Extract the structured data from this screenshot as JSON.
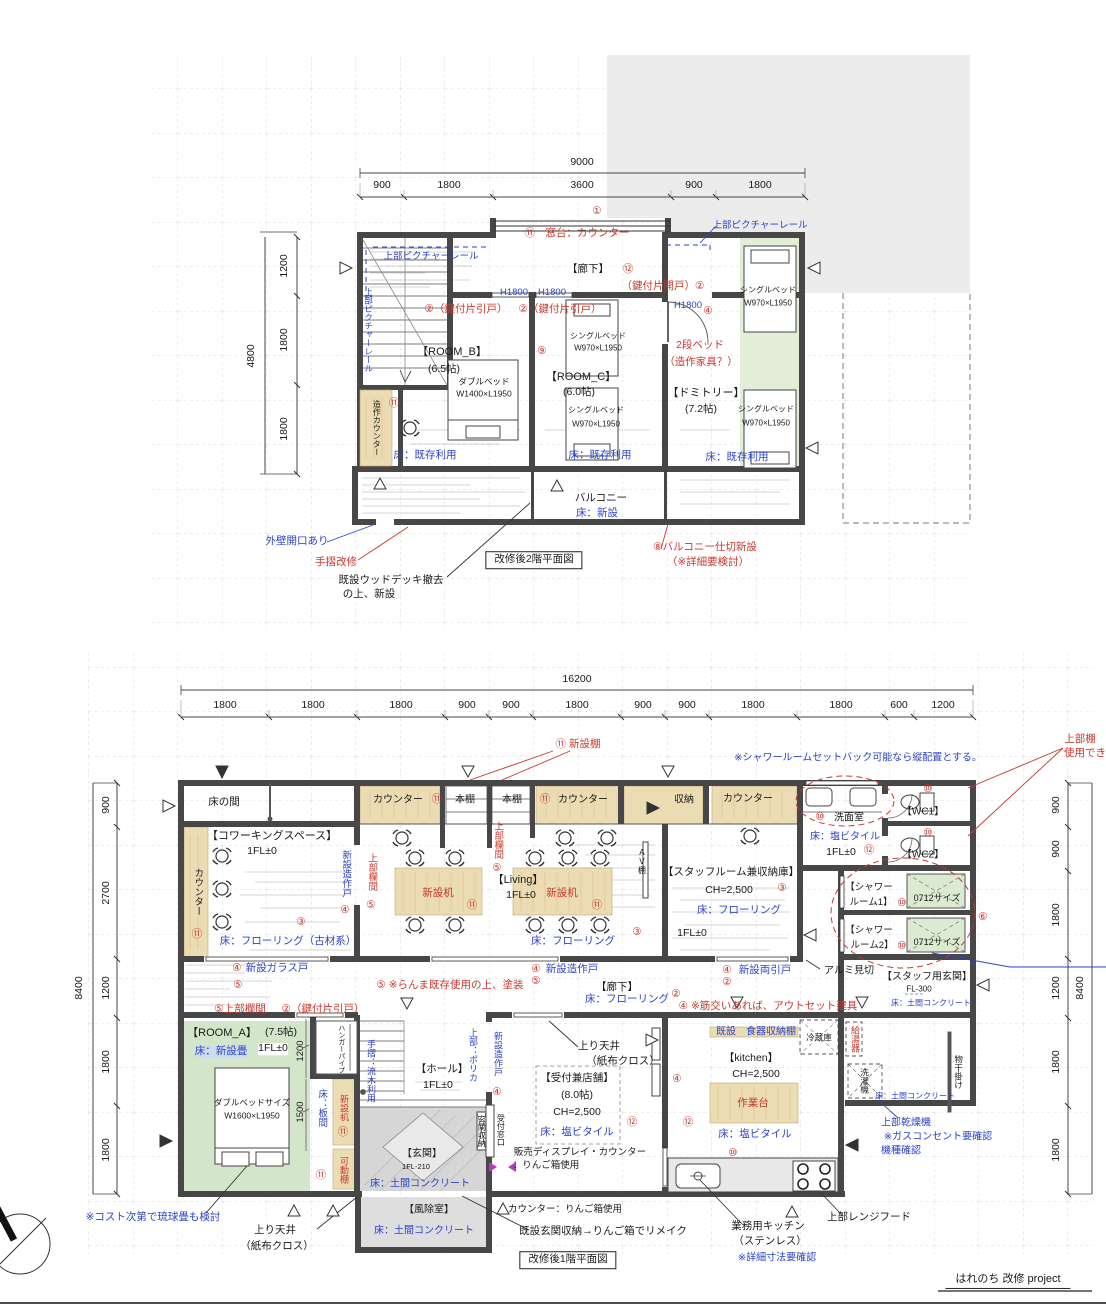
{
  "colors": {
    "red": "#c8372d",
    "blue": "#2b43c8",
    "black": "#1a1a1a",
    "magenta": "#b935c9"
  },
  "project": {
    "title": "はれのち 改修 project"
  },
  "plan2f_title": "改修後2階平面図",
  "plan1f_title": "改修後1階平面図",
  "labels2f": [
    {
      "n": "dim-total-2f",
      "t": "9000",
      "x": 582,
      "y": 163
    },
    {
      "t": "900",
      "x": 382,
      "y": 186
    },
    {
      "t": "1800",
      "x": 449,
      "y": 186
    },
    {
      "t": "3600",
      "x": 582,
      "y": 186
    },
    {
      "t": "900",
      "x": 694,
      "y": 186
    },
    {
      "t": "1800",
      "x": 760,
      "y": 186
    },
    {
      "t": "4800",
      "x": 252,
      "y": 356,
      "r": -90
    },
    {
      "t": "1200",
      "x": 285,
      "y": 266,
      "r": -90
    },
    {
      "t": "1800",
      "x": 285,
      "y": 340,
      "r": -90
    },
    {
      "t": "1800",
      "x": 285,
      "y": 429,
      "r": -90
    },
    {
      "t": "①",
      "x": 597,
      "y": 212,
      "c": "red"
    },
    {
      "t": "⑪　窓台：カウンター",
      "x": 577,
      "y": 234,
      "c": "red"
    },
    {
      "t": "上部ピクチャーレール",
      "x": 760,
      "y": 226,
      "c": "blue",
      "s": 9.5
    },
    {
      "t": "上部ピクチャーレール",
      "x": 431,
      "y": 257,
      "c": "blue",
      "s": 9.5
    },
    {
      "t": "上部ピクチャーレール",
      "x": 368,
      "y": 330,
      "c": "blue",
      "s": 8.5,
      "v": 1
    },
    {
      "t": "【廊下】",
      "x": 588,
      "y": 270
    },
    {
      "t": "⑫",
      "x": 628,
      "y": 270,
      "c": "red"
    },
    {
      "t": "（鍵付片開戸）②",
      "x": 663,
      "y": 287,
      "c": "red"
    },
    {
      "t": "H1800",
      "x": 514,
      "y": 293,
      "c": "blue",
      "s": 9.5
    },
    {
      "t": "H1800",
      "x": 552,
      "y": 293,
      "c": "blue",
      "s": 9.5
    },
    {
      "t": "②（鍵付片引戸）",
      "x": 466,
      "y": 310,
      "c": "red"
    },
    {
      "t": "②（鍵付片引戸）",
      "x": 560,
      "y": 310,
      "c": "red"
    },
    {
      "t": "H1800",
      "x": 688,
      "y": 306,
      "c": "blue",
      "s": 9.5
    },
    {
      "t": "④",
      "x": 708,
      "y": 312,
      "c": "red"
    },
    {
      "t": "⑨",
      "x": 542,
      "y": 352,
      "c": "red"
    },
    {
      "n": "room-b-title",
      "t": "【ROOM_B】",
      "x": 452,
      "y": 352,
      "s": 11
    },
    {
      "t": "(6.5帖)",
      "x": 444,
      "y": 370
    },
    {
      "t": "ダブルベッド",
      "x": 484,
      "y": 382,
      "s": 8.5
    },
    {
      "t": "W1400×L1950",
      "x": 484,
      "y": 394,
      "s": 8.5
    },
    {
      "n": "room-c-title",
      "t": "【ROOM_C】",
      "x": 581,
      "y": 377,
      "s": 11
    },
    {
      "t": "(6.0帖)",
      "x": 579,
      "y": 393
    },
    {
      "t": "シングルベッド",
      "x": 598,
      "y": 337,
      "s": 8
    },
    {
      "t": "W970×L1950",
      "x": 598,
      "y": 349,
      "s": 8
    },
    {
      "t": "シングルベッド",
      "x": 596,
      "y": 411,
      "s": 8
    },
    {
      "t": "W970×L1950",
      "x": 596,
      "y": 425,
      "s": 8
    },
    {
      "t": "2段ベッド",
      "x": 700,
      "y": 346,
      "c": "red"
    },
    {
      "t": "（造作家具？）",
      "x": 701,
      "y": 363,
      "c": "red"
    },
    {
      "n": "dormitory-title",
      "t": "【ドミトリー】",
      "x": 706,
      "y": 393,
      "s": 11
    },
    {
      "t": "(7.2帖)",
      "x": 701,
      "y": 410
    },
    {
      "t": "シングルベッド",
      "x": 768,
      "y": 291,
      "s": 8
    },
    {
      "t": "W970×L1950",
      "x": 768,
      "y": 304,
      "s": 8
    },
    {
      "t": "シングルベッド",
      "x": 766,
      "y": 410,
      "s": 8
    },
    {
      "t": "W970×L1950",
      "x": 766,
      "y": 424,
      "s": 8
    },
    {
      "t": "床：既存利用",
      "x": 425,
      "y": 456,
      "c": "blue"
    },
    {
      "t": "床：既存利用",
      "x": 600,
      "y": 456,
      "c": "blue"
    },
    {
      "t": "床：既存利用",
      "x": 737,
      "y": 458,
      "c": "blue"
    },
    {
      "t": "造作カウンター",
      "x": 376,
      "y": 428,
      "s": 8,
      "v": 1
    },
    {
      "t": "⑪",
      "x": 394,
      "y": 404,
      "c": "red"
    },
    {
      "t": "バルコニー",
      "x": 601,
      "y": 499
    },
    {
      "t": "床：新設",
      "x": 597,
      "y": 514,
      "c": "blue"
    },
    {
      "t": "外壁開口あり",
      "x": 297,
      "y": 542,
      "c": "blue"
    },
    {
      "t": "手摺改修",
      "x": 336,
      "y": 563,
      "c": "red"
    },
    {
      "t": "既設ウッドデッキ撤去",
      "x": 391,
      "y": 581
    },
    {
      "t": "の上、新設",
      "x": 369,
      "y": 595
    },
    {
      "n": "plan2f-title",
      "t": "改修後2階平面図",
      "x": 534,
      "y": 560,
      "bd": 1
    },
    {
      "t": "⑧バルコニー仕切新設",
      "x": 705,
      "y": 548,
      "c": "red"
    },
    {
      "t": "（※詳細要検討）",
      "x": 708,
      "y": 563,
      "c": "red"
    }
  ],
  "labels1f": [
    {
      "n": "dim-total-1f",
      "t": "16200",
      "x": 577,
      "y": 680
    },
    {
      "t": "1800",
      "x": 225,
      "y": 706
    },
    {
      "t": "1800",
      "x": 313,
      "y": 706
    },
    {
      "t": "1800",
      "x": 401,
      "y": 706
    },
    {
      "t": "900",
      "x": 467,
      "y": 706
    },
    {
      "t": "900",
      "x": 511,
      "y": 706
    },
    {
      "t": "1800",
      "x": 577,
      "y": 706
    },
    {
      "t": "900",
      "x": 643,
      "y": 706
    },
    {
      "t": "900",
      "x": 687,
      "y": 706
    },
    {
      "t": "1800",
      "x": 753,
      "y": 706
    },
    {
      "t": "1800",
      "x": 841,
      "y": 706
    },
    {
      "t": "600",
      "x": 899,
      "y": 706
    },
    {
      "t": "1200",
      "x": 943,
      "y": 706
    },
    {
      "t": "8400",
      "x": 80,
      "y": 988,
      "r": -90
    },
    {
      "t": "900",
      "x": 107,
      "y": 805,
      "r": -90
    },
    {
      "t": "2700",
      "x": 107,
      "y": 893,
      "r": -90
    },
    {
      "t": "1200",
      "x": 107,
      "y": 988,
      "r": -90
    },
    {
      "t": "1800",
      "x": 107,
      "y": 1062,
      "r": -90
    },
    {
      "t": "1800",
      "x": 107,
      "y": 1150,
      "r": -90
    },
    {
      "t": "900",
      "x": 1057,
      "y": 805,
      "r": -90
    },
    {
      "t": "900",
      "x": 1057,
      "y": 849,
      "r": -90
    },
    {
      "t": "1800",
      "x": 1057,
      "y": 915,
      "r": -90
    },
    {
      "t": "1200",
      "x": 1057,
      "y": 988,
      "r": -90
    },
    {
      "t": "1800",
      "x": 1057,
      "y": 1062,
      "r": -90
    },
    {
      "t": "1800",
      "x": 1057,
      "y": 1150,
      "r": -90
    },
    {
      "t": "8400",
      "x": 1081,
      "y": 988,
      "r": -90
    },
    {
      "t": "⑪ 新設棚",
      "x": 578,
      "y": 745,
      "c": "red"
    },
    {
      "t": "※シャワールームセットバック可能なら縦配置とする。",
      "x": 858,
      "y": 758,
      "c": "blue",
      "s": 10
    },
    {
      "t": "上部棚",
      "x": 1080,
      "y": 740,
      "c": "red"
    },
    {
      "t": "使用でき",
      "x": 1085,
      "y": 754,
      "c": "red"
    },
    {
      "t": "床の間",
      "x": 224,
      "y": 803
    },
    {
      "t": "カウンター",
      "x": 398,
      "y": 800,
      "s": 10
    },
    {
      "t": "⑪",
      "x": 437,
      "y": 800,
      "c": "red"
    },
    {
      "t": "本棚",
      "x": 465,
      "y": 800,
      "s": 10
    },
    {
      "t": "本棚",
      "x": 512,
      "y": 800,
      "s": 10
    },
    {
      "t": "⑪",
      "x": 545,
      "y": 800,
      "c": "red"
    },
    {
      "t": "カウンター",
      "x": 583,
      "y": 800,
      "s": 10
    },
    {
      "t": "収納",
      "x": 684,
      "y": 800,
      "s": 10
    },
    {
      "t": "カウンター",
      "x": 748,
      "y": 799,
      "s": 10
    },
    {
      "t": "⑩",
      "x": 820,
      "y": 818,
      "c": "red"
    },
    {
      "t": "洗面室",
      "x": 849,
      "y": 818,
      "s": 10
    },
    {
      "t": "床：塩ビタイル",
      "x": 845,
      "y": 837,
      "c": "blue",
      "s": 10
    },
    {
      "t": "1FL±0",
      "x": 841,
      "y": 853
    },
    {
      "t": "⑫",
      "x": 869,
      "y": 851,
      "c": "red"
    },
    {
      "n": "wc1-title",
      "t": "【WC1】",
      "x": 923,
      "y": 812,
      "s": 10
    },
    {
      "t": "⑩",
      "x": 928,
      "y": 790,
      "c": "red"
    },
    {
      "n": "wc2-title",
      "t": "【WC2】",
      "x": 923,
      "y": 855,
      "s": 10
    },
    {
      "t": "⑩",
      "x": 928,
      "y": 834,
      "c": "red"
    },
    {
      "t": "【シャワー",
      "x": 869,
      "y": 888,
      "s": 9.5
    },
    {
      "t": "ルーム1】",
      "x": 871,
      "y": 903,
      "s": 9.5
    },
    {
      "t": "⑩",
      "x": 902,
      "y": 904,
      "c": "red"
    },
    {
      "t": "0712サイズ",
      "x": 937,
      "y": 899,
      "s": 9
    },
    {
      "t": "【シャワー",
      "x": 869,
      "y": 931,
      "s": 9.5
    },
    {
      "t": "ルーム2】",
      "x": 872,
      "y": 946,
      "s": 9.5
    },
    {
      "t": "⑩",
      "x": 902,
      "y": 947,
      "c": "red"
    },
    {
      "t": "0712サイズ",
      "x": 937,
      "y": 943,
      "s": 9
    },
    {
      "t": "⑥",
      "x": 983,
      "y": 918,
      "c": "red"
    },
    {
      "t": "アルミ見切",
      "x": 849,
      "y": 971,
      "s": 10
    },
    {
      "n": "staff-entrance-title",
      "t": "【スタッフ用玄関】",
      "x": 927,
      "y": 977,
      "s": 10
    },
    {
      "t": "FL-300",
      "x": 919,
      "y": 990,
      "s": 8
    },
    {
      "t": "床：土間コンクリート",
      "x": 931,
      "y": 1004,
      "c": "blue",
      "s": 8
    },
    {
      "n": "coworking-title",
      "t": "【コワーキングスペース】",
      "x": 272,
      "y": 836,
      "s": 11
    },
    {
      "t": "1FL±0",
      "x": 262,
      "y": 852
    },
    {
      "t": "カウンター",
      "x": 197,
      "y": 892,
      "s": 9.5,
      "v": 1
    },
    {
      "t": "⑪",
      "x": 197,
      "y": 935,
      "c": "red"
    },
    {
      "t": "③",
      "x": 301,
      "y": 923,
      "c": "red"
    },
    {
      "t": "床：フローリング（古材系）",
      "x": 288,
      "y": 942,
      "c": "blue"
    },
    {
      "t": "新設造作戸",
      "x": 345,
      "y": 874,
      "c": "blue",
      "s": 9.5,
      "v": 1
    },
    {
      "t": "④",
      "x": 345,
      "y": 911,
      "c": "red"
    },
    {
      "t": "上部欄間",
      "x": 371,
      "y": 872,
      "c": "red",
      "s": 9.5,
      "v": 1
    },
    {
      "t": "⑤",
      "x": 371,
      "y": 906,
      "c": "red"
    },
    {
      "t": "新設机",
      "x": 438,
      "y": 894,
      "c": "red"
    },
    {
      "t": "⑪",
      "x": 472,
      "y": 906,
      "c": "red"
    },
    {
      "n": "living-title",
      "t": "【Living】",
      "x": 518,
      "y": 880,
      "s": 11
    },
    {
      "t": "1FL±0",
      "x": 521,
      "y": 896
    },
    {
      "t": "新設机",
      "x": 562,
      "y": 894,
      "c": "red"
    },
    {
      "t": "⑪",
      "x": 597,
      "y": 906,
      "c": "red"
    },
    {
      "t": "上部欄間",
      "x": 497,
      "y": 840,
      "c": "red",
      "s": 9.5,
      "v": 1
    },
    {
      "t": "⑤",
      "x": 497,
      "y": 869,
      "c": "red"
    },
    {
      "t": "AV棚",
      "x": 641,
      "y": 861,
      "s": 8,
      "v": 1
    },
    {
      "t": "③",
      "x": 637,
      "y": 933,
      "c": "red"
    },
    {
      "t": "床：フローリング",
      "x": 573,
      "y": 942,
      "c": "blue"
    },
    {
      "n": "staffroom-title",
      "t": "【スタッフルーム兼収納庫】",
      "x": 731,
      "y": 873,
      "s": 10.5
    },
    {
      "t": "CH=2,500",
      "x": 729,
      "y": 891
    },
    {
      "t": "③",
      "x": 782,
      "y": 889,
      "c": "red"
    },
    {
      "t": "床：フローリング",
      "x": 739,
      "y": 911,
      "c": "blue"
    },
    {
      "t": "1FL±0",
      "x": 692,
      "y": 934
    },
    {
      "t": "④",
      "x": 237,
      "y": 969,
      "c": "red"
    },
    {
      "t": "新設ガラス戸",
      "x": 277,
      "y": 969,
      "c": "blue"
    },
    {
      "t": "⑤",
      "x": 238,
      "y": 986,
      "c": "red"
    },
    {
      "t": "⑤ ※らんま既存使用の上、塗装",
      "x": 450,
      "y": 986,
      "c": "red"
    },
    {
      "t": "④",
      "x": 536,
      "y": 970,
      "c": "red"
    },
    {
      "t": "新設造作戸",
      "x": 572,
      "y": 970,
      "c": "blue"
    },
    {
      "t": "⑤",
      "x": 536,
      "y": 982,
      "c": "red"
    },
    {
      "t": "④",
      "x": 727,
      "y": 971,
      "c": "red"
    },
    {
      "t": "新設両引戸",
      "x": 765,
      "y": 971,
      "c": "blue"
    },
    {
      "t": "②",
      "x": 727,
      "y": 983,
      "c": "red"
    },
    {
      "n": "corridor-title",
      "t": "【廊下】",
      "x": 617,
      "y": 988
    },
    {
      "t": "床：フローリング",
      "x": 627,
      "y": 1000,
      "c": "blue"
    },
    {
      "t": "②",
      "x": 676,
      "y": 995,
      "c": "red"
    },
    {
      "t": "④ ※筋交いあれば、アウトセット建具",
      "x": 768,
      "y": 1007,
      "c": "red"
    },
    {
      "t": "⑤上部欄間",
      "x": 240,
      "y": 1010,
      "c": "red"
    },
    {
      "t": "②（鍵付片引戸）",
      "x": 323,
      "y": 1010,
      "c": "red"
    },
    {
      "n": "room-a-title",
      "t": "【ROOM_A】",
      "x": 222,
      "y": 1033,
      "s": 11
    },
    {
      "t": "(7.5帖)",
      "x": 281,
      "y": 1033
    },
    {
      "t": "床：新設畳",
      "x": 221,
      "y": 1052,
      "c": "blue",
      "bg": "#ccdcf0"
    },
    {
      "t": "1FL±0",
      "x": 273,
      "y": 1049,
      "bg": "#ffffff"
    },
    {
      "t": "1200",
      "x": 301,
      "y": 1051,
      "r": -90,
      "s": 9.5
    },
    {
      "t": "1500",
      "x": 301,
      "y": 1112,
      "r": -90,
      "s": 9.5
    },
    {
      "t": "ダブルベッドサイズ",
      "x": 252,
      "y": 1103,
      "s": 8.5
    },
    {
      "t": "W1600×L1950",
      "x": 252,
      "y": 1116,
      "s": 8.5
    },
    {
      "t": "床：板間",
      "x": 321,
      "y": 1108,
      "c": "blue",
      "s": 9.5,
      "v": 1
    },
    {
      "t": "新設机",
      "x": 343,
      "y": 1108,
      "c": "red",
      "s": 9,
      "v": 1
    },
    {
      "t": "⑪",
      "x": 343,
      "y": 1133,
      "c": "red"
    },
    {
      "t": "ハンガーパイプ",
      "x": 341,
      "y": 1049,
      "s": 7,
      "v": 1
    },
    {
      "t": "可動棚",
      "x": 343,
      "y": 1170,
      "c": "red",
      "s": 9,
      "v": 1
    },
    {
      "t": "⑪",
      "x": 321,
      "y": 1176,
      "c": "red"
    },
    {
      "t": "※コスト次第で琉球畳も検討",
      "x": 153,
      "y": 1218,
      "c": "blue"
    },
    {
      "t": "上り天井",
      "x": 275,
      "y": 1231
    },
    {
      "t": "（紙布クロス）",
      "x": 277,
      "y": 1247
    },
    {
      "n": "hall-title",
      "t": "【ホール】",
      "x": 442,
      "y": 1070
    },
    {
      "t": "1FL±0",
      "x": 438,
      "y": 1086
    },
    {
      "t": "手摺：流木利用",
      "x": 370,
      "y": 1071,
      "c": "blue",
      "s": 9,
      "v": 1
    },
    {
      "t": "上部：ポリカ",
      "x": 472,
      "y": 1055,
      "c": "blue",
      "s": 9,
      "v": 1
    },
    {
      "t": "新設造作戸",
      "x": 497,
      "y": 1054,
      "c": "blue",
      "s": 9,
      "v": 1
    },
    {
      "t": "④",
      "x": 497,
      "y": 1093,
      "c": "red"
    },
    {
      "t": "玄関収納",
      "x": 481,
      "y": 1131,
      "s": 8,
      "v": 1
    },
    {
      "t": "受付窓口",
      "x": 500,
      "y": 1130,
      "s": 8,
      "v": 1
    },
    {
      "n": "entrance-title",
      "t": "【玄関】",
      "x": 422,
      "y": 1154,
      "s": 10
    },
    {
      "t": "1FL-210",
      "x": 416,
      "y": 1167,
      "s": 7.5
    },
    {
      "t": "床：土間コンクリート",
      "x": 420,
      "y": 1184,
      "c": "blue",
      "s": 10
    },
    {
      "n": "windbreak-title",
      "t": "【風除室】",
      "x": 429,
      "y": 1210,
      "s": 10
    },
    {
      "t": "床：土間コンクリート",
      "x": 424,
      "y": 1231,
      "c": "blue",
      "s": 10
    },
    {
      "t": "上り天井",
      "x": 599,
      "y": 1047
    },
    {
      "t": "（紙布クロス）",
      "x": 623,
      "y": 1062
    },
    {
      "n": "reception-title",
      "t": "【受付兼店舗】",
      "x": 577,
      "y": 1079
    },
    {
      "t": "(8.0帖)",
      "x": 577,
      "y": 1096
    },
    {
      "t": "CH=2,500",
      "x": 577,
      "y": 1113
    },
    {
      "t": "床：塩ビタイル",
      "x": 577,
      "y": 1133,
      "c": "blue"
    },
    {
      "t": "⑫",
      "x": 632,
      "y": 1123,
      "c": "red"
    },
    {
      "t": "販売ディスプレイ・カウンター",
      "x": 580,
      "y": 1153,
      "s": 9.5
    },
    {
      "t": "：りんご箱使用",
      "x": 546,
      "y": 1166,
      "s": 9.5
    },
    {
      "t": "カウンター：りんご箱使用",
      "x": 565,
      "y": 1210,
      "s": 9.5
    },
    {
      "t": "既設玄関収納→りんご箱でリメイク",
      "x": 603,
      "y": 1232,
      "s": 10.5
    },
    {
      "t": "既設　食器収納棚",
      "x": 756,
      "y": 1032,
      "c": "blue",
      "s": 10
    },
    {
      "t": "冷蔵庫",
      "x": 819,
      "y": 1038,
      "s": 8.5
    },
    {
      "n": "kitchen-title",
      "t": "【kitchen】",
      "x": 751,
      "y": 1059
    },
    {
      "t": "CH=2,500",
      "x": 756,
      "y": 1075
    },
    {
      "t": "作業台",
      "x": 753,
      "y": 1104,
      "c": "red"
    },
    {
      "t": "床：塩ビタイル",
      "x": 755,
      "y": 1135,
      "c": "blue"
    },
    {
      "t": "④",
      "x": 677,
      "y": 1080,
      "c": "red"
    },
    {
      "t": "⑫",
      "x": 688,
      "y": 1123,
      "c": "red"
    },
    {
      "t": "⑩",
      "x": 733,
      "y": 1154,
      "c": "red"
    },
    {
      "t": "業務用キッチン",
      "x": 768,
      "y": 1227,
      "s": 10.5
    },
    {
      "t": "（ステンレス）",
      "x": 770,
      "y": 1242,
      "s": 10.5
    },
    {
      "t": "※詳細寸法要確認",
      "x": 777,
      "y": 1258,
      "c": "blue",
      "s": 10
    },
    {
      "t": "上部レンジフード",
      "x": 869,
      "y": 1218,
      "s": 10.5
    },
    {
      "t": "給湯器",
      "x": 854,
      "y": 1039,
      "c": "red",
      "s": 9,
      "v": 1
    },
    {
      "t": "洗濯機",
      "x": 864,
      "y": 1081,
      "s": 8.5,
      "v": 1
    },
    {
      "t": "物干掛け",
      "x": 958,
      "y": 1072,
      "s": 8.5,
      "v": 1
    },
    {
      "t": "床：土間コンクリート",
      "x": 915,
      "y": 1097,
      "c": "blue",
      "s": 8
    },
    {
      "t": "上部乾燥機",
      "x": 906,
      "y": 1123,
      "c": "blue",
      "s": 10
    },
    {
      "t": "※ガスコンセント要確認",
      "x": 938,
      "y": 1137,
      "c": "blue",
      "s": 10
    },
    {
      "t": "機種確認",
      "x": 901,
      "y": 1151,
      "c": "blue",
      "s": 10
    },
    {
      "n": "plan1f-title",
      "t": "改修後1階平面図",
      "x": 568,
      "y": 1260,
      "bd": 1
    },
    {
      "n": "project-title",
      "t": "はれのち 改修 project",
      "x": 1008,
      "y": 1281,
      "s": 11,
      "u": 1
    }
  ]
}
